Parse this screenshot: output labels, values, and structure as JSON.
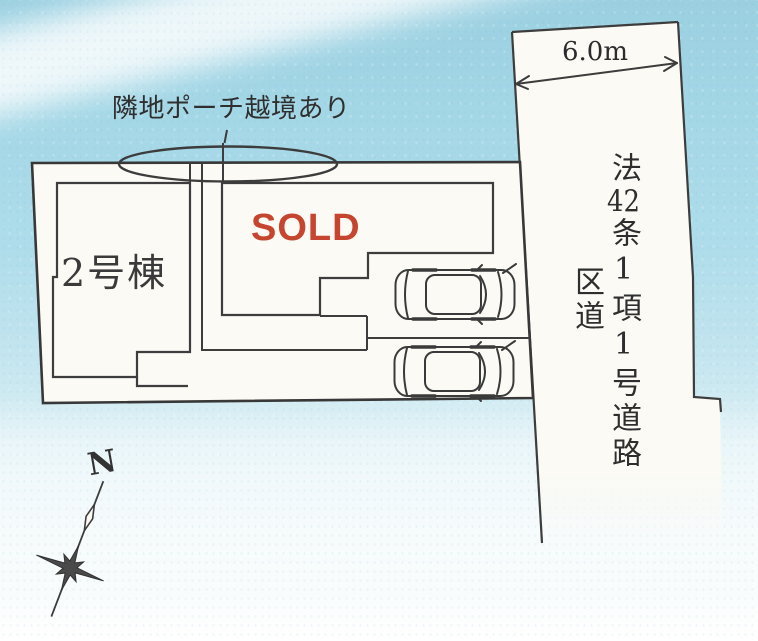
{
  "annotation": {
    "label": "隣地ポーチ越境あり"
  },
  "buildings": {
    "unit2": {
      "label": "2号棟"
    },
    "unit1": {
      "status_label": "SOLD",
      "status_color": "#c5452f"
    }
  },
  "road": {
    "width_label": "6.0m",
    "classification": "法42条1項1号道路",
    "classification_parts": {
      "prefix": "法",
      "number": "42",
      "suffix": "条1項1号道路"
    },
    "category": "区道"
  },
  "parking": {
    "car_count": 2
  },
  "compass": {
    "north_label": "N"
  },
  "palette": {
    "line": "#3d3d3d",
    "paper": "#fbfaf5",
    "sky_blue": "#a5d8e6",
    "sold_red": "#c5452f",
    "text": "#2f2f2f"
  }
}
